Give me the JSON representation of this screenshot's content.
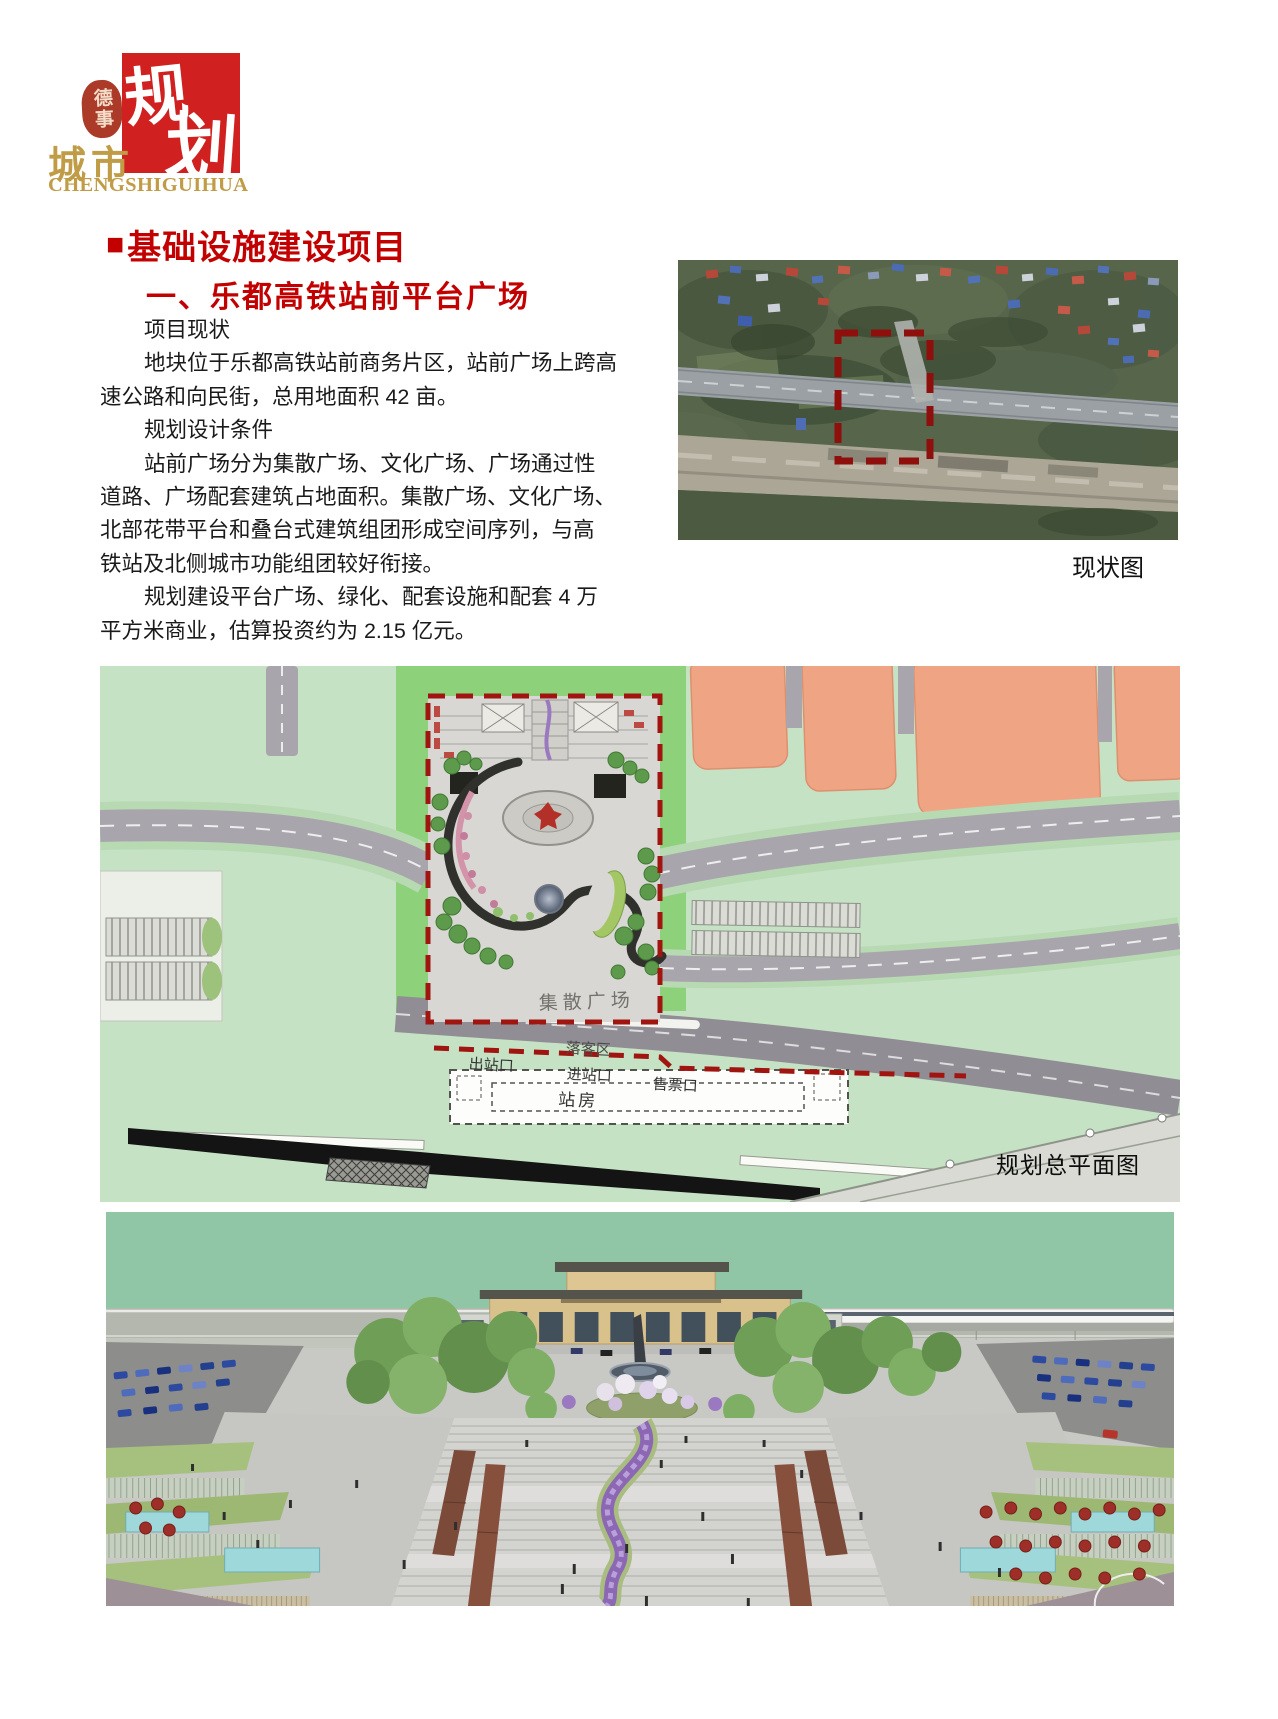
{
  "logo": {
    "seal_text": "德事",
    "brand_char_1": "规",
    "brand_char_2": "划",
    "brand_cn": "城市",
    "brand_en": "CHENGSHIGUIHUA"
  },
  "section": {
    "bullet": "■",
    "title": "基础设施建设项目",
    "subtitle": "一、乐都高铁站前平台广场"
  },
  "article": {
    "lines": [
      {
        "text": "项目现状"
      },
      {
        "text": "地块位于乐都高铁站前商务片区，站前广场上跨高"
      },
      {
        "text": "速公路和向民街，总用地面积 42 亩。"
      },
      {
        "text": "规划设计条件"
      },
      {
        "text": "站前广场分为集散广场、文化广场、广场通过性"
      },
      {
        "text": "道路、广场配套建筑占地面积。集散广场、文化广场、"
      },
      {
        "text": "北部花带平台和叠台式建筑组团形成空间序列，与高"
      },
      {
        "text": "铁站及北侧城市功能组团较好衔接。"
      },
      {
        "text": "规划建设平台广场、绿化、配套设施和配套 4 万"
      },
      {
        "text": "平方米商业，估算投资约为 2.15 亿元。"
      }
    ]
  },
  "figures": {
    "satellite": {
      "caption": "现状图"
    },
    "plan": {
      "caption": "规划总平面图",
      "labels": {
        "gather_plaza": "集散广场",
        "dropoff": "落客区",
        "exit": "出站口",
        "entrance": "进站口",
        "ticket": "售票口",
        "station_house": "站房"
      }
    }
  },
  "colors": {
    "accent_red": "#c30000",
    "logo_red": "#d02020",
    "logo_gold": "#bf9c45",
    "site_boundary_red": "#a01310"
  }
}
